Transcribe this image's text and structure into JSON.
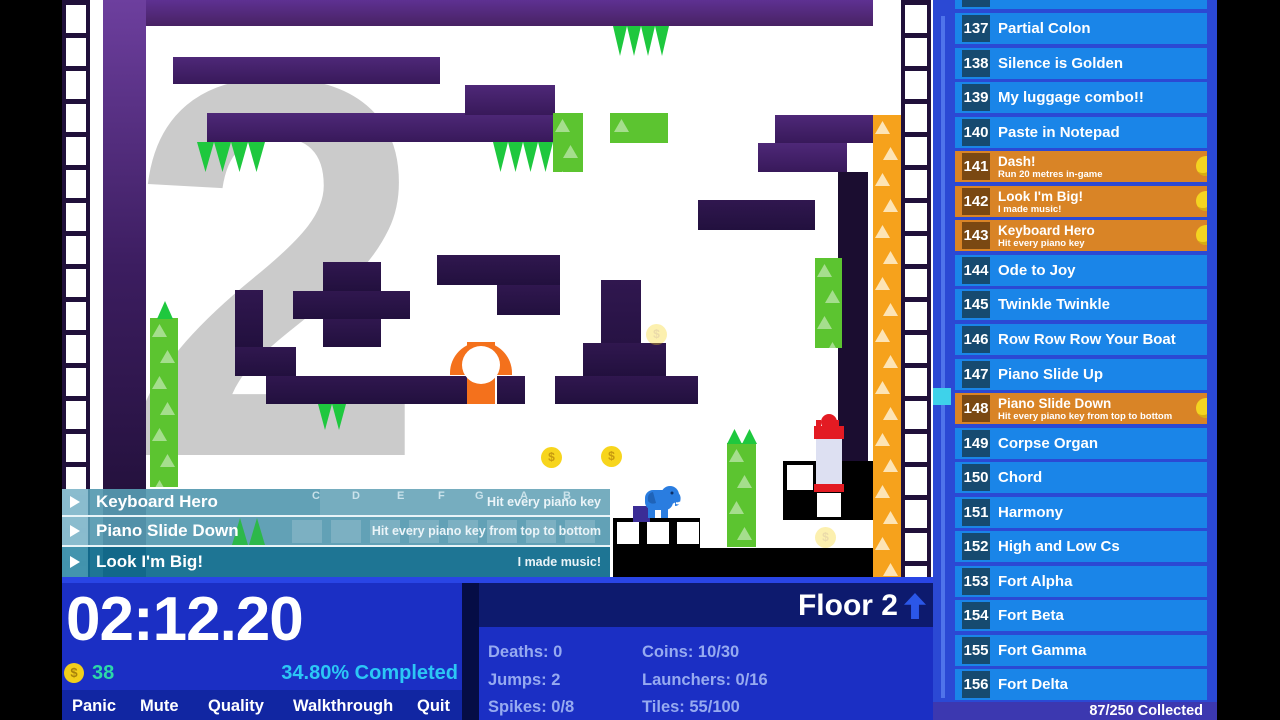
{
  "hud": {
    "timer": "02:12.20",
    "coin_symbol": "$",
    "coin_count": "38",
    "completed": "34.80% Completed",
    "menu": [
      "Panic",
      "Mute",
      "Quality",
      "Walkthrough",
      "Quit"
    ],
    "floor_label": "Floor 2",
    "stats_left": [
      "Deaths: 0",
      "Jumps: 2",
      "Spikes: 0/8"
    ],
    "stats_right": [
      "Coins: 10/30",
      "Launchers: 0/16",
      "Tiles: 55/100"
    ]
  },
  "toasts": [
    {
      "title": "Keyboard Hero",
      "note": "Hit every piano key"
    },
    {
      "title": "Piano Slide Down",
      "note": "Hit every piano key from top to bottom"
    },
    {
      "title": "Look I'm Big!",
      "note": "I made music!"
    }
  ],
  "scene": {
    "background_numeral": "2",
    "coin_symbol": "$",
    "piano_letters": [
      "C",
      "D",
      "E",
      "F",
      "G",
      "A",
      "B"
    ]
  },
  "sidebar": {
    "items": [
      {
        "num": "137",
        "label": "Partial Colon"
      },
      {
        "num": "138",
        "label": "Silence is Golden"
      },
      {
        "num": "139",
        "label": "My luggage combo!!"
      },
      {
        "num": "140",
        "label": "Paste in Notepad"
      },
      {
        "num": "141",
        "label": "Dash!",
        "subtitle": "Run 20 metres in-game",
        "highlight": true,
        "coin": true
      },
      {
        "num": "142",
        "label": "Look I'm Big!",
        "subtitle": "I made music!",
        "highlight": true,
        "coin": true
      },
      {
        "num": "143",
        "label": "Keyboard Hero",
        "subtitle": "Hit every piano key",
        "highlight": true,
        "coin": true
      },
      {
        "num": "144",
        "label": "Ode to Joy"
      },
      {
        "num": "145",
        "label": "Twinkle Twinkle"
      },
      {
        "num": "146",
        "label": "Row Row Row Your Boat"
      },
      {
        "num": "147",
        "label": "Piano Slide Up"
      },
      {
        "num": "148",
        "label": "Piano Slide Down",
        "subtitle": "Hit every piano key from top to bottom",
        "highlight": true,
        "coin": true
      },
      {
        "num": "149",
        "label": "Corpse Organ"
      },
      {
        "num": "150",
        "label": "Chord"
      },
      {
        "num": "151",
        "label": "Harmony"
      },
      {
        "num": "152",
        "label": "High and Low Cs"
      },
      {
        "num": "153",
        "label": "Fort Alpha"
      },
      {
        "num": "154",
        "label": "Fort Beta"
      },
      {
        "num": "155",
        "label": "Fort Gamma"
      },
      {
        "num": "156",
        "label": "Fort Delta"
      }
    ],
    "footer": "87/250 Collected"
  },
  "colors": {
    "row_blue": "#1a85e8",
    "highlight_orange": "#d98426",
    "coin_yellow": "#f4d421",
    "spike_green": "#1ec83e",
    "platform_purple": "#4e2878",
    "hud_blue": "#1b2fc4",
    "completed_cyan": "#2cc7f5",
    "coin_count_teal": "#2cd8a8",
    "toast_teal": "#569ab0"
  }
}
